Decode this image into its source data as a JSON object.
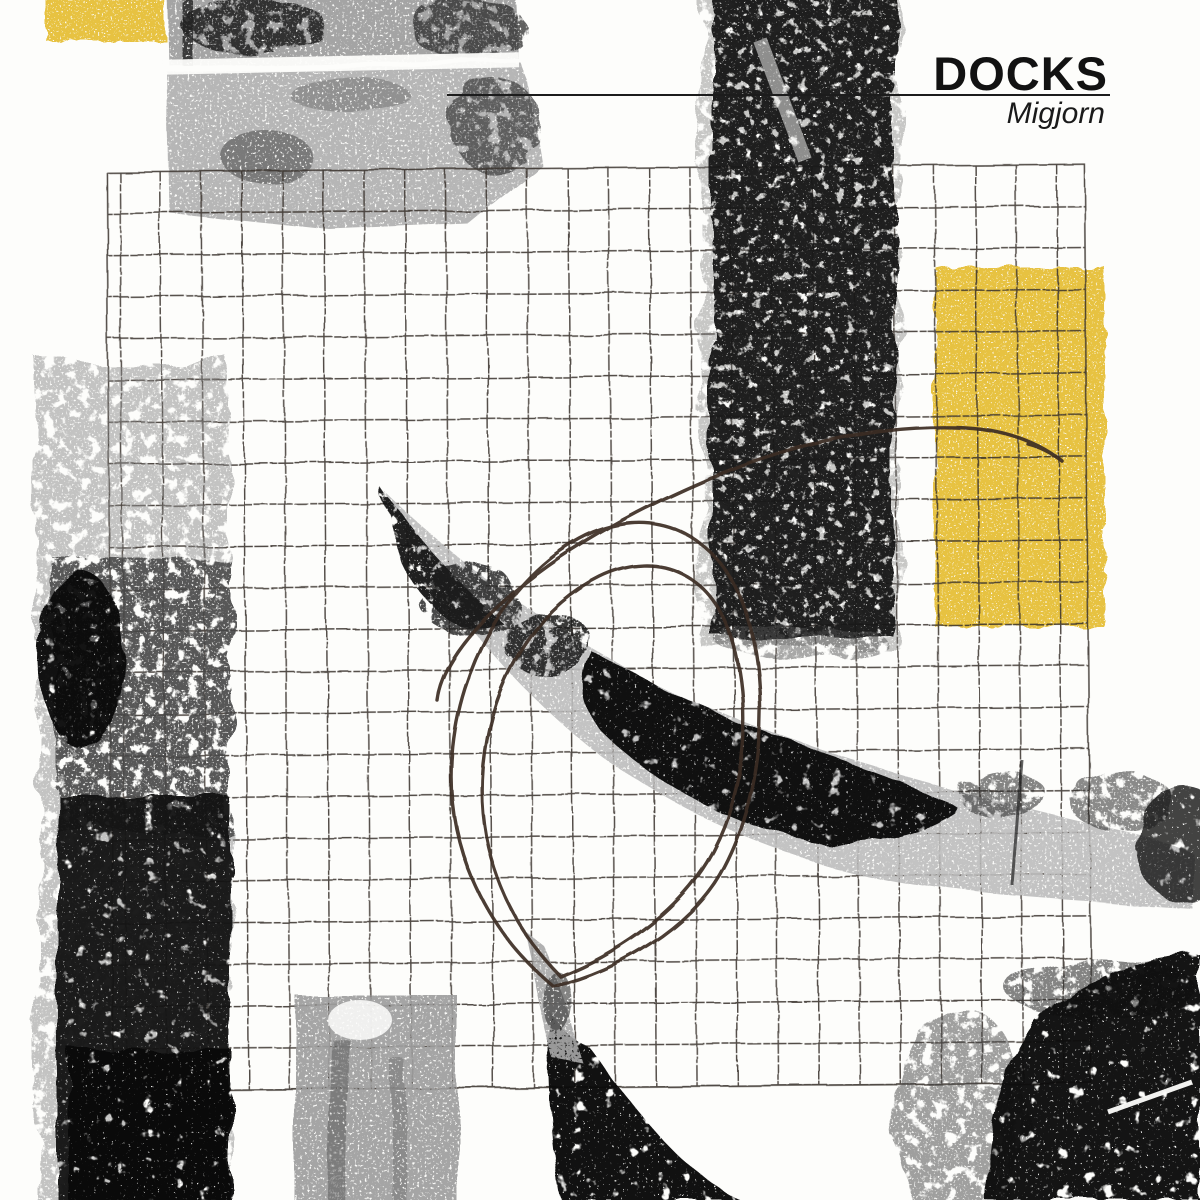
{
  "header": {
    "title": "DOCKS",
    "artist": "Migjorn"
  },
  "colors": {
    "paper": "#fdfdfb",
    "yellow": "#e7c241",
    "ink_black": "#131313",
    "ink_gray": "#a9a9a9",
    "pencil_brown": "#3c2d24",
    "grid_line": "#39322c",
    "title_black": "#121212"
  }
}
